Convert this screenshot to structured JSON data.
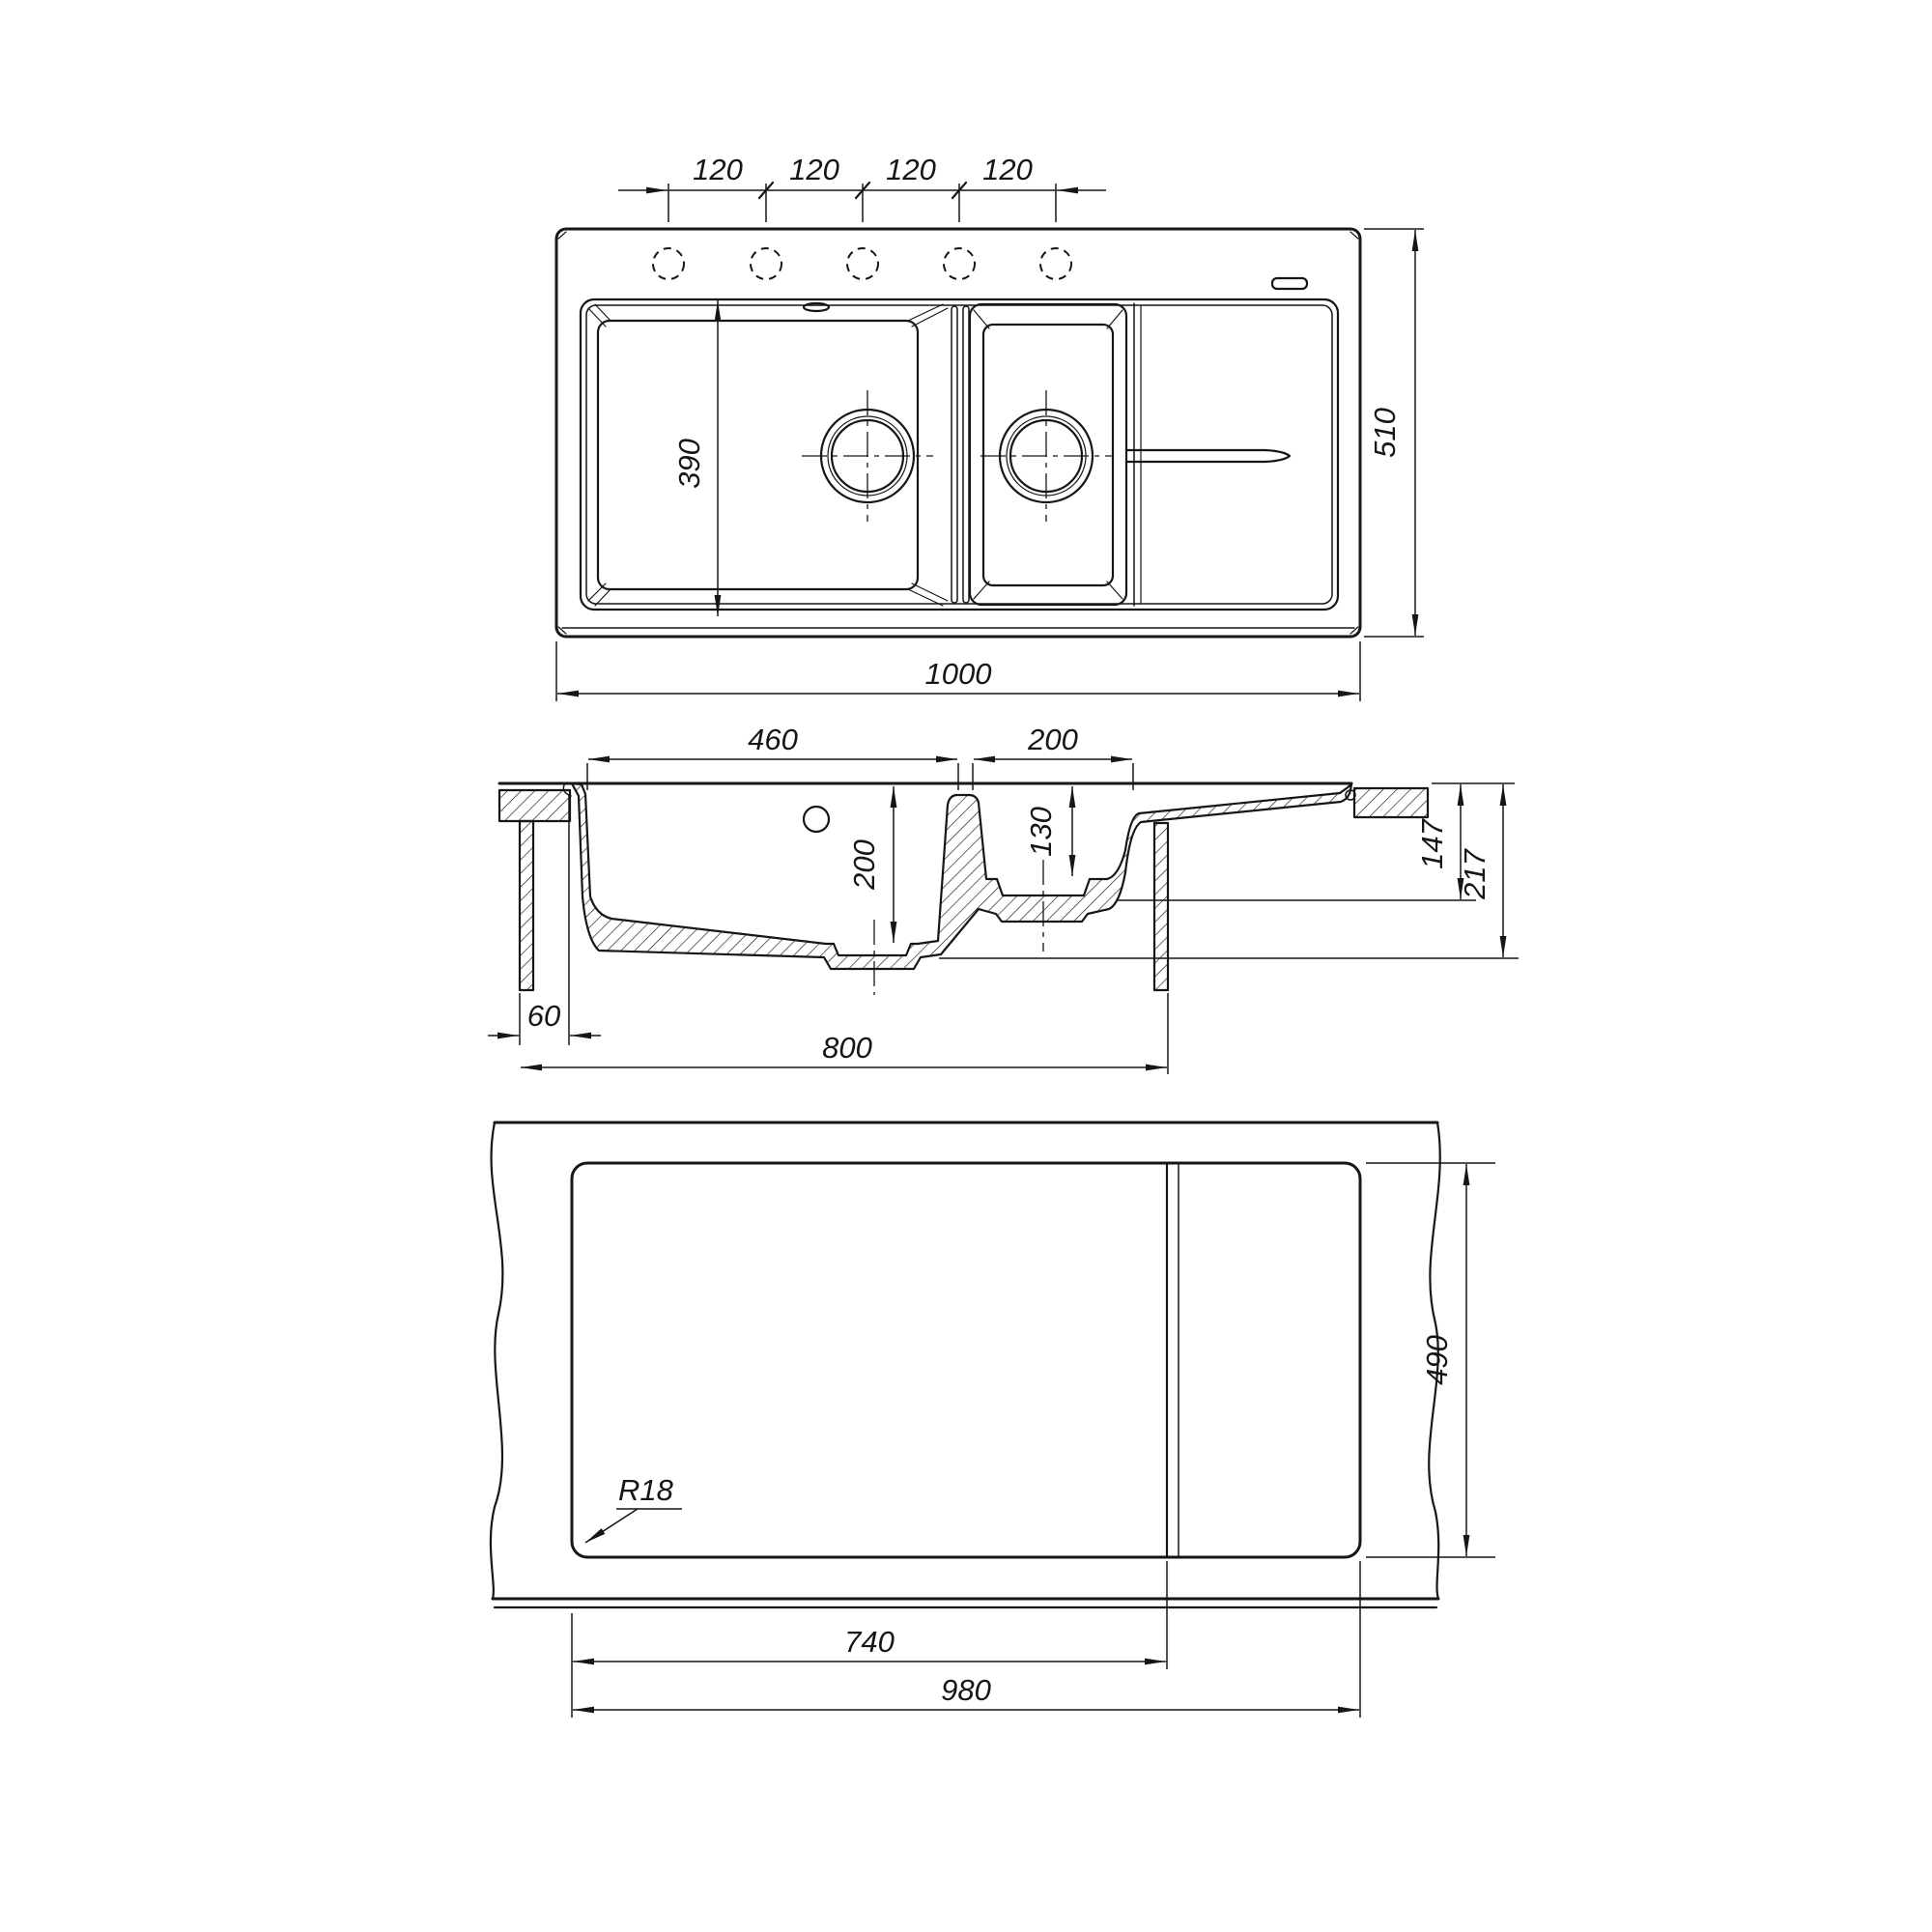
{
  "drawing": {
    "type": "technical-drawing",
    "subject": "kitchen sink with one and a half bowls and drainboard - installation dimensions",
    "background_color": "#ffffff",
    "line_color": "#161616",
    "views": {
      "top": {
        "name": "top plan view",
        "dims": {
          "hole_spacing": [
            "120",
            "120",
            "120",
            "120"
          ],
          "bowl_opening_depth": "390",
          "overall_width": "1000",
          "overall_depth": "510"
        }
      },
      "section": {
        "name": "cross section view",
        "dims": {
          "main_bowl_width": "460",
          "small_bowl_width": "200",
          "main_bowl_depth": "200",
          "small_bowl_depth": "130",
          "height_at_drainboard": "147",
          "height_overall": "217",
          "edge_to_cabinet_offset": "60",
          "cabinet_width": "800"
        }
      },
      "bottom": {
        "name": "underside / worktop cutout view",
        "dims": {
          "corner_radius": "R18",
          "cutout_depth": "490",
          "cutout_width_bowl_section": "740",
          "cutout_width_total": "980"
        }
      }
    }
  }
}
